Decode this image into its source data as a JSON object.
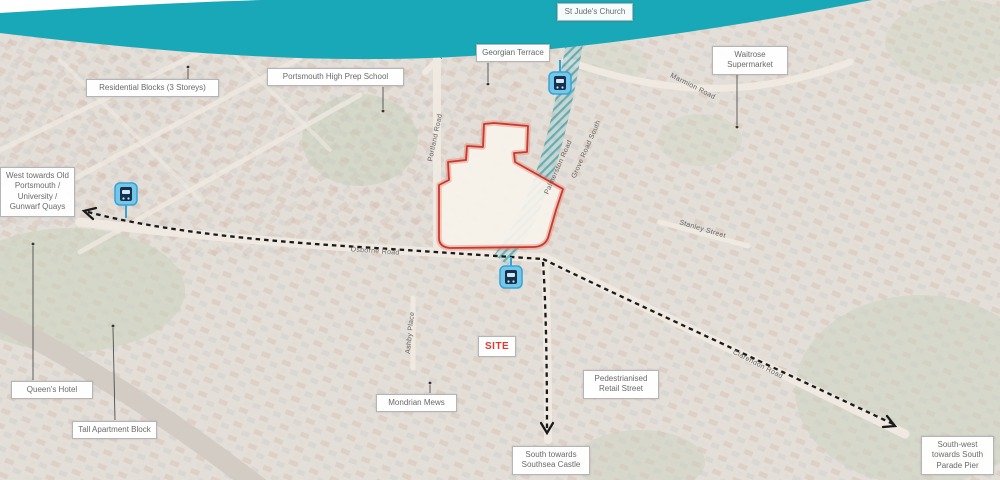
{
  "callouts": {
    "residential_blocks": "Residential Blocks (3 Storeys)",
    "prep_school": "Portsmouth High Prep School",
    "st_judes": "St Jude's Church",
    "georgian_terrace": "Georgian Terrace",
    "waitrose": "Waitrose Supermarket",
    "west_towards": "West towards Old Portsmouth / University / Gunwarf Quays",
    "queens_hotel": "Queen's Hotel",
    "tall_apartment": "Tall Apartment Block",
    "mondrian_mews": "Mondrian Mews",
    "site": "SITE",
    "pedestrianised": "Pedestrianised Retail Street",
    "south_towards": "South towards Southsea Castle",
    "south_west": "South-west towards South Parade Pier"
  },
  "street_labels": {
    "kent_road": "Kent Road",
    "marmion_road": "Marmion Road",
    "portland_road": "Portland Road",
    "palmerston_road": "Palmerston Road",
    "grove_road_south": "Grove Road South",
    "osborne_road": "Osborne Road",
    "stanley_street": "Stanley Street",
    "ashby_place": "Ashby Place",
    "clarendon_road": "Clarendon Road"
  },
  "icons": {
    "bus_stop": "bus-stop-icon"
  },
  "colors": {
    "wave_teal": "#18a8b8",
    "site_outline_red": "#c63a2c",
    "site_label_red": "#e03a2f",
    "route_dash_black": "#1a1a1a",
    "bus_icon_fill": "#74c7e8",
    "bus_icon_border": "#36a3d6",
    "hatch_teal": "#17828c",
    "map_base": "#d6cec4"
  }
}
